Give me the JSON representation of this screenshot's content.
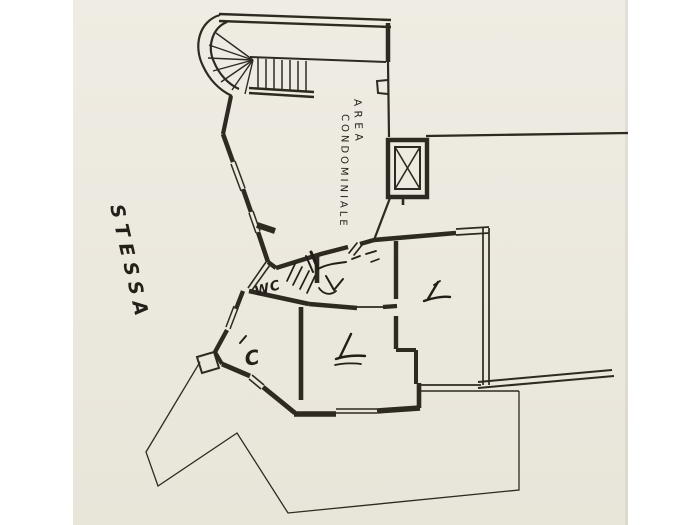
{
  "scan": {
    "paper_color": "#ebe8de",
    "margin_color": "#ffffff",
    "ink_color": "#2e2921",
    "pen_color": "#221d17"
  },
  "plan": {
    "type": "scanned architectural floor plan",
    "labels": {
      "common_area_line1": "AREA",
      "common_area_line2": "CONDOMINIALE",
      "margin_note": "STESSA",
      "wc": "WC",
      "room_letter": "C"
    },
    "features": [
      "spiral-stair",
      "straight-stair-treads",
      "elevator-shaft",
      "window-wall-segments",
      "terrace-outline",
      "balcony-parapet",
      "handwritten-check-marks",
      "door-hatch-scribbles"
    ]
  }
}
